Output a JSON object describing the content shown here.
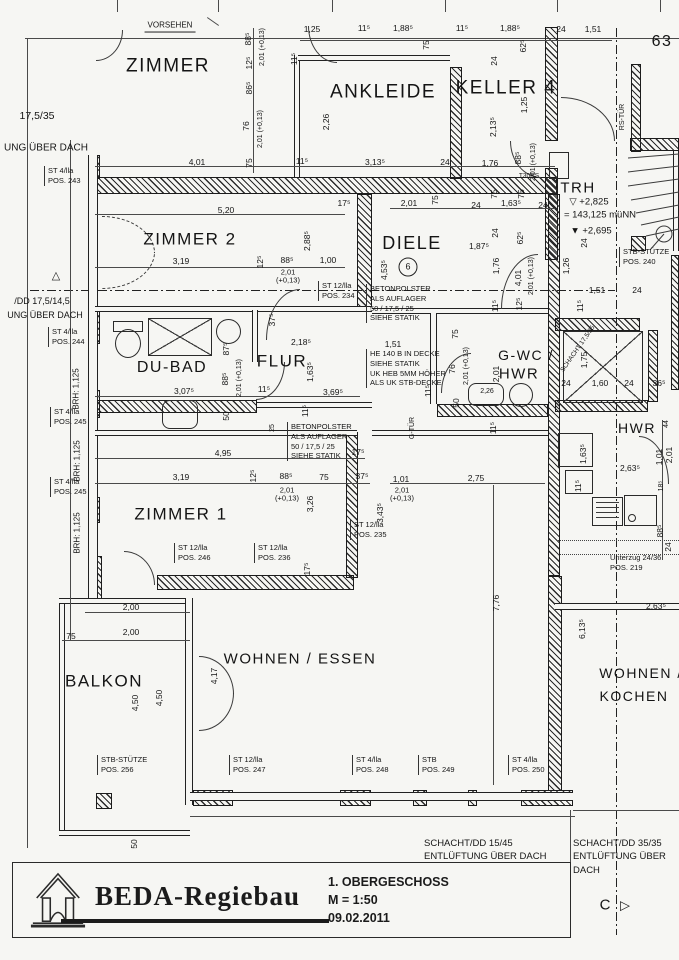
{
  "colors": {
    "paper": "#f6f6f3",
    "ink": "#1a1a1a"
  },
  "title_block": {
    "company": "BEDA-Regiebau",
    "drawing_title": "1. OBERGESCHOSS",
    "scale": "M = 1:50",
    "date": "09.02.2011"
  },
  "plan": {
    "labels": [
      {
        "t": "ZIMMER",
        "x": 168,
        "y": 66,
        "c": "room",
        "s": 19,
        "n": "room-label-zimmer"
      },
      {
        "t": "ANKLEIDE",
        "x": 383,
        "y": 92,
        "c": "room",
        "s": 19,
        "n": "room-label-ankleide"
      },
      {
        "t": "KELLER 4",
        "x": 506,
        "y": 88,
        "c": "room",
        "s": 19,
        "n": "room-label-keller4"
      },
      {
        "t": "ZIMMER 2",
        "x": 190,
        "y": 239,
        "c": "room",
        "s": 17,
        "n": "room-label-zimmer2"
      },
      {
        "t": "DIELE",
        "x": 412,
        "y": 243,
        "c": "room",
        "s": 18,
        "n": "room-label-diele"
      },
      {
        "t": "TRH",
        "x": 578,
        "y": 189,
        "c": "room",
        "s": 15,
        "n": "room-label-trh"
      },
      {
        "t": "DU-BAD",
        "x": 172,
        "y": 368,
        "c": "room",
        "s": 16,
        "n": "room-label-dubad"
      },
      {
        "t": "FLUR",
        "x": 282,
        "y": 361,
        "c": "room",
        "s": 17,
        "n": "room-label-flur"
      },
      {
        "t": "G-WC /",
        "x": 526,
        "y": 356,
        "c": "room",
        "s": 14,
        "n": "room-label-gwc"
      },
      {
        "t": "HWR",
        "x": 519,
        "y": 375,
        "c": "room",
        "s": 15,
        "n": "room-label-gwc-hwr"
      },
      {
        "t": "HWR",
        "x": 637,
        "y": 429,
        "c": "room",
        "s": 14,
        "n": "room-label-hwr"
      },
      {
        "t": "ZIMMER 1",
        "x": 181,
        "y": 514,
        "c": "room",
        "s": 17,
        "n": "room-label-zimmer1"
      },
      {
        "t": "BALKON",
        "x": 104,
        "y": 681,
        "c": "room",
        "s": 17,
        "n": "room-label-balkon"
      },
      {
        "t": "WOHNEN / ESSEN",
        "x": 300,
        "y": 660,
        "c": "room",
        "s": 15,
        "n": "room-label-wohnen-essen"
      },
      {
        "t": "WOHNEN /",
        "x": 641,
        "y": 674,
        "c": "room",
        "s": 14,
        "n": "room-label-wohnen-kochen-1"
      },
      {
        "t": "KOCHEN",
        "x": 634,
        "y": 697,
        "c": "room",
        "s": 14,
        "n": "room-label-wohnen-kochen-2"
      },
      {
        "t": "63",
        "x": 662,
        "y": 42,
        "c": "room",
        "s": 16,
        "n": "sheet-number"
      },
      {
        "t": "6",
        "x": 408,
        "y": 267,
        "c": "circ",
        "s": 9,
        "n": "room-number-badge"
      },
      {
        "t": "VORSEHEN",
        "x": 170,
        "y": 27,
        "c": "flag",
        "n": "vorsehen-note"
      },
      {
        "t": "▽ +2,825",
        "x": 589,
        "y": 203,
        "s": 9.5,
        "n": "level-mark"
      },
      {
        "t": "= 143,125 müNN",
        "x": 600,
        "y": 216,
        "s": 9.5,
        "n": "level-mark"
      },
      {
        "t": "▼ +2,695",
        "x": 591,
        "y": 232,
        "s": 9.5,
        "n": "level-mark"
      },
      {
        "t": "RS-TÜR",
        "x": 623,
        "y": 117,
        "r": -90,
        "s": 7,
        "n": "door-tag"
      },
      {
        "t": "T30RS",
        "x": 529,
        "y": 176,
        "s": 6.5,
        "n": "door-tag"
      },
      {
        "t": "G-TÜR",
        "x": 413,
        "y": 428,
        "r": -90,
        "s": 7,
        "n": "door-tag"
      },
      {
        "t": "17,5/35",
        "x": 37,
        "y": 117,
        "s": 10.5,
        "n": "margin-note"
      },
      {
        "t": "UNG ÜBER DACH",
        "x": 46,
        "y": 148,
        "s": 10,
        "n": "margin-note"
      },
      {
        "t": "△",
        "x": 56,
        "y": 276,
        "s": 11,
        "n": "axis-triangle-marker"
      },
      {
        "t": "/DD 17,5/14,5",
        "x": 42,
        "y": 301,
        "s": 9,
        "n": "margin-note"
      },
      {
        "t": "UNG ÜBER DACH",
        "x": 45,
        "y": 315,
        "s": 9,
        "n": "margin-note"
      },
      {
        "t": "BRH: 1,125",
        "x": 77,
        "y": 389,
        "r": -90,
        "s": 8,
        "n": "sill-height-label"
      },
      {
        "t": "BRH: 1,125",
        "x": 78,
        "y": 461,
        "r": -90,
        "s": 8,
        "n": "sill-height-label"
      },
      {
        "t": "BRH: 1,125",
        "x": 78,
        "y": 533,
        "r": -90,
        "s": 8,
        "n": "sill-height-label"
      },
      {
        "t": "1,25",
        "x": 312,
        "y": 30
      },
      {
        "t": "11⁵",
        "x": 364,
        "y": 29
      },
      {
        "t": "1,88⁵",
        "x": 403,
        "y": 29
      },
      {
        "t": "11⁵",
        "x": 462,
        "y": 29
      },
      {
        "t": "1,88⁵",
        "x": 510,
        "y": 29
      },
      {
        "t": "24",
        "x": 561,
        "y": 30
      },
      {
        "t": "1,51",
        "x": 593,
        "y": 30
      },
      {
        "t": "88⁵",
        "x": 249,
        "y": 39,
        "r": -90
      },
      {
        "t": "2,01 (+0,13)",
        "x": 263,
        "y": 47,
        "r": -90,
        "s": 7
      },
      {
        "t": "12⁵",
        "x": 250,
        "y": 63,
        "r": -90
      },
      {
        "t": "86⁵",
        "x": 250,
        "y": 88,
        "r": -90
      },
      {
        "t": "76",
        "x": 247,
        "y": 126,
        "r": -90
      },
      {
        "t": "2,01 (+0,13)",
        "x": 261,
        "y": 129,
        "r": -90,
        "s": 7
      },
      {
        "t": "75",
        "x": 250,
        "y": 163,
        "r": -90
      },
      {
        "t": "11⁵",
        "x": 295,
        "y": 59,
        "r": -90
      },
      {
        "t": "2,26",
        "x": 327,
        "y": 122,
        "r": -90
      },
      {
        "t": "75",
        "x": 427,
        "y": 45,
        "r": -90
      },
      {
        "t": "62⁵",
        "x": 524,
        "y": 46,
        "r": -90
      },
      {
        "t": "24",
        "x": 495,
        "y": 61,
        "r": -90
      },
      {
        "t": "1,25",
        "x": 525,
        "y": 105,
        "r": -90
      },
      {
        "t": "2,13⁵",
        "x": 494,
        "y": 127,
        "r": -90
      },
      {
        "t": "1,76",
        "x": 490,
        "y": 164
      },
      {
        "t": "88⁵",
        "x": 519,
        "y": 158,
        "r": -90
      },
      {
        "t": "2,01 (+0,13)",
        "x": 534,
        "y": 162,
        "r": -90,
        "s": 7
      },
      {
        "t": "4,01",
        "x": 197,
        "y": 163
      },
      {
        "t": "11⁵",
        "x": 302,
        "y": 162
      },
      {
        "t": "3,13⁵",
        "x": 375,
        "y": 163
      },
      {
        "t": "24",
        "x": 445,
        "y": 163
      },
      {
        "t": "5,20",
        "x": 226,
        "y": 211
      },
      {
        "t": "17⁵",
        "x": 344,
        "y": 204
      },
      {
        "t": "2,01",
        "x": 409,
        "y": 204
      },
      {
        "t": "75",
        "x": 436,
        "y": 200,
        "r": -90
      },
      {
        "t": "24",
        "x": 476,
        "y": 206
      },
      {
        "t": "75",
        "x": 495,
        "y": 194,
        "r": -90
      },
      {
        "t": "1,63⁵",
        "x": 511,
        "y": 204
      },
      {
        "t": "75",
        "x": 522,
        "y": 194,
        "r": -90
      },
      {
        "t": "24",
        "x": 543,
        "y": 206
      },
      {
        "t": "3,19",
        "x": 181,
        "y": 262
      },
      {
        "t": "12⁵",
        "x": 261,
        "y": 262,
        "r": -90
      },
      {
        "t": "88⁵",
        "x": 287,
        "y": 261
      },
      {
        "t": "2,01\n(+0,13)",
        "x": 288,
        "y": 277,
        "c": "dim2"
      },
      {
        "t": "1,00",
        "x": 328,
        "y": 261
      },
      {
        "t": "2,88⁵",
        "x": 308,
        "y": 241,
        "r": -90
      },
      {
        "t": "4,53⁵",
        "x": 385,
        "y": 270,
        "r": -90
      },
      {
        "t": "24",
        "x": 496,
        "y": 233,
        "r": -90
      },
      {
        "t": "62⁵",
        "x": 521,
        "y": 238,
        "r": -90
      },
      {
        "t": "1,87⁵",
        "x": 479,
        "y": 247
      },
      {
        "t": "1,76",
        "x": 497,
        "y": 266,
        "r": -90
      },
      {
        "t": "4,01",
        "x": 519,
        "y": 278,
        "r": -90
      },
      {
        "t": "2,01 (+0,13)",
        "x": 532,
        "y": 276,
        "r": -90,
        "s": 7
      },
      {
        "t": "11⁵",
        "x": 496,
        "y": 306,
        "r": -90
      },
      {
        "t": "12⁵",
        "x": 520,
        "y": 304,
        "r": -90
      },
      {
        "t": "24",
        "x": 585,
        "y": 243,
        "r": -90
      },
      {
        "t": "1,26",
        "x": 567,
        "y": 266,
        "r": -90
      },
      {
        "t": "1,51",
        "x": 597,
        "y": 291
      },
      {
        "t": "24",
        "x": 637,
        "y": 291
      },
      {
        "t": "11⁵",
        "x": 581,
        "y": 306,
        "r": -90
      },
      {
        "t": "SCHACHT 17,5/35",
        "x": 578,
        "y": 349,
        "r": -55,
        "s": 6.5,
        "n": "shaft-tag"
      },
      {
        "t": "1,75",
        "x": 585,
        "y": 360,
        "r": -90
      },
      {
        "t": "24",
        "x": 566,
        "y": 384
      },
      {
        "t": "1,60",
        "x": 600,
        "y": 384
      },
      {
        "t": "24",
        "x": 629,
        "y": 384
      },
      {
        "t": "36⁵",
        "x": 659,
        "y": 384
      },
      {
        "t": "37⁵",
        "x": 273,
        "y": 320,
        "r": -90
      },
      {
        "t": "2,18⁵",
        "x": 301,
        "y": 343
      },
      {
        "t": "87⁵",
        "x": 227,
        "y": 349,
        "r": -90
      },
      {
        "t": "88⁵",
        "x": 226,
        "y": 379,
        "r": -90
      },
      {
        "t": "2,01 (+0,13)",
        "x": 240,
        "y": 378,
        "r": -90,
        "s": 7
      },
      {
        "t": "1,63⁵",
        "x": 311,
        "y": 372,
        "r": -90
      },
      {
        "t": "3,07⁵",
        "x": 184,
        "y": 392
      },
      {
        "t": "11⁵",
        "x": 264,
        "y": 390
      },
      {
        "t": "3,69⁵",
        "x": 333,
        "y": 393
      },
      {
        "t": "50",
        "x": 227,
        "y": 416,
        "r": -90
      },
      {
        "t": "11⁵",
        "x": 306,
        "y": 411,
        "r": -90
      },
      {
        "t": "25",
        "x": 273,
        "y": 428,
        "r": -90,
        "s": 7
      },
      {
        "t": "4,95",
        "x": 223,
        "y": 454
      },
      {
        "t": "1,51",
        "x": 393,
        "y": 345
      },
      {
        "t": "75",
        "x": 456,
        "y": 334,
        "r": -90
      },
      {
        "t": "76",
        "x": 453,
        "y": 369,
        "r": -90
      },
      {
        "t": "2,01 (+0,13)",
        "x": 467,
        "y": 366,
        "r": -90,
        "s": 7
      },
      {
        "t": "2,01",
        "x": 497,
        "y": 374,
        "r": -90
      },
      {
        "t": "2,26",
        "x": 487,
        "y": 392,
        "s": 7
      },
      {
        "t": "11⁵",
        "x": 429,
        "y": 391,
        "r": -90
      },
      {
        "t": "50",
        "x": 457,
        "y": 403,
        "r": -90
      },
      {
        "t": "11⁵",
        "x": 494,
        "y": 428,
        "r": -90
      },
      {
        "t": "17⁵",
        "x": 358,
        "y": 453
      },
      {
        "t": "3,19",
        "x": 181,
        "y": 478
      },
      {
        "t": "12⁵",
        "x": 254,
        "y": 476,
        "r": -90
      },
      {
        "t": "88⁵",
        "x": 286,
        "y": 477
      },
      {
        "t": "75",
        "x": 324,
        "y": 478
      },
      {
        "t": "37⁵",
        "x": 362,
        "y": 477
      },
      {
        "t": "2,01\n(+0,13)",
        "x": 287,
        "y": 495,
        "c": "dim2"
      },
      {
        "t": "3,26",
        "x": 311,
        "y": 504,
        "r": -90
      },
      {
        "t": "1,01",
        "x": 401,
        "y": 480
      },
      {
        "t": "2,75",
        "x": 476,
        "y": 479
      },
      {
        "t": "2,01\n(+0,13)",
        "x": 402,
        "y": 495,
        "c": "dim2"
      },
      {
        "t": "3,43⁵",
        "x": 381,
        "y": 513,
        "r": -90
      },
      {
        "t": "17⁵",
        "x": 308,
        "y": 569,
        "r": -90
      },
      {
        "t": "7,76",
        "x": 497,
        "y": 603,
        "r": -90
      },
      {
        "t": "44",
        "x": 667,
        "y": 424,
        "r": -90,
        "s": 7
      },
      {
        "t": "1,63⁵",
        "x": 584,
        "y": 454,
        "r": -90
      },
      {
        "t": "11⁵",
        "x": 579,
        "y": 486,
        "r": -90
      },
      {
        "t": "2,63⁵",
        "x": 630,
        "y": 469
      },
      {
        "t": "1,01",
        "x": 660,
        "y": 457,
        "r": -90
      },
      {
        "t": "2,01",
        "x": 670,
        "y": 455,
        "r": -90
      },
      {
        "t": "18⁵",
        "x": 662,
        "y": 486,
        "r": -90,
        "s": 7
      },
      {
        "t": "88⁵",
        "x": 661,
        "y": 531,
        "r": -90
      },
      {
        "t": "24",
        "x": 669,
        "y": 547,
        "r": -90
      },
      {
        "t": "2,63⁵",
        "x": 656,
        "y": 607
      },
      {
        "t": "6,13⁵",
        "x": 583,
        "y": 629,
        "r": -90
      },
      {
        "t": "2,00",
        "x": 131,
        "y": 608
      },
      {
        "t": "2,00",
        "x": 131,
        "y": 633
      },
      {
        "t": "75",
        "x": 71,
        "y": 637
      },
      {
        "t": "4,50",
        "x": 136,
        "y": 703,
        "r": -90
      },
      {
        "t": "4,50",
        "x": 160,
        "y": 698,
        "r": -90
      },
      {
        "t": "4,17",
        "x": 215,
        "y": 676,
        "r": -90
      },
      {
        "t": "50",
        "x": 135,
        "y": 844,
        "r": -90
      },
      {
        "t": "ST 4/lla\nPOS. 243",
        "x": 44,
        "y": 166,
        "c": "post",
        "n": "pos-label"
      },
      {
        "t": "ST 12/lla\nPOS. 234",
        "x": 318,
        "y": 281,
        "c": "post",
        "n": "pos-label"
      },
      {
        "t": "BETONPOLSTER\nALS AUFLAGER\n50 / 17,5 / 25\nSIEHE STATIK",
        "x": 366,
        "y": 284,
        "c": "post",
        "n": "betonpolster-note"
      },
      {
        "t": "HE 140 B IN DECKE\nSIEHE STATIK\nUK HEB 5MM HÖHER\nALS UK STB-DECKE",
        "x": 366,
        "y": 349,
        "c": "post",
        "n": "he140-note"
      },
      {
        "t": "BETONPOLSTER\nALS AUFLAGER\n50 / 17,5 / 25\nSIEHE STATIK",
        "x": 287,
        "y": 422,
        "c": "post",
        "n": "betonpolster-note"
      },
      {
        "t": "ST 4/lla\nPOS. 244",
        "x": 48,
        "y": 327,
        "c": "post",
        "n": "pos-label"
      },
      {
        "t": "ST 4/lla\nPOS. 245",
        "x": 50,
        "y": 407,
        "c": "post",
        "n": "pos-label"
      },
      {
        "t": "ST 4/lla\nPOS. 245",
        "x": 50,
        "y": 477,
        "c": "post",
        "n": "pos-label"
      },
      {
        "t": "ST 12/lla\nPOS. 235",
        "x": 350,
        "y": 520,
        "c": "post",
        "n": "pos-label"
      },
      {
        "t": "ST 12/lla\nPOS. 246",
        "x": 174,
        "y": 543,
        "c": "post",
        "n": "pos-label"
      },
      {
        "t": "ST 12/lla\nPOS. 236",
        "x": 254,
        "y": 543,
        "c": "post",
        "n": "pos-label"
      },
      {
        "t": "STB-STÜTZE\nPOS. 256",
        "x": 97,
        "y": 755,
        "c": "post",
        "n": "pos-label"
      },
      {
        "t": "ST 12/lla\nPOS. 247",
        "x": 229,
        "y": 755,
        "c": "post",
        "n": "pos-label"
      },
      {
        "t": "ST 4/lla\nPOS. 248",
        "x": 352,
        "y": 755,
        "c": "post",
        "n": "pos-label"
      },
      {
        "t": "STB\nPOS. 249",
        "x": 418,
        "y": 755,
        "c": "post",
        "n": "pos-label"
      },
      {
        "t": "ST 4/lla\nPOS. 250",
        "x": 508,
        "y": 755,
        "c": "post",
        "n": "pos-label"
      },
      {
        "t": "STB-STÜTZE\nPOS. 240",
        "x": 619,
        "y": 247,
        "c": "post",
        "n": "pos-label"
      },
      {
        "t": "Unterzug 24/36\nPOS. 219",
        "x": 610,
        "y": 553,
        "c": "note",
        "n": "unterzug-note"
      },
      {
        "t": "SCHACHT/DD 15/45\nENTLÜFTUNG ÜBER DACH",
        "x": 424,
        "y": 837,
        "c": "note9",
        "n": "schacht-note"
      },
      {
        "t": "SCHACHT/DD 35/35\nENTLÜFTUNG ÜBER DACH",
        "x": 573,
        "y": 837,
        "c": "note9",
        "n": "schacht-note"
      },
      {
        "t": "C",
        "x": 605,
        "y": 906,
        "s": 15,
        "n": "section-marker-letter"
      },
      {
        "t": "▷",
        "x": 625,
        "y": 906,
        "s": 13,
        "n": "section-marker-arrow"
      }
    ]
  }
}
